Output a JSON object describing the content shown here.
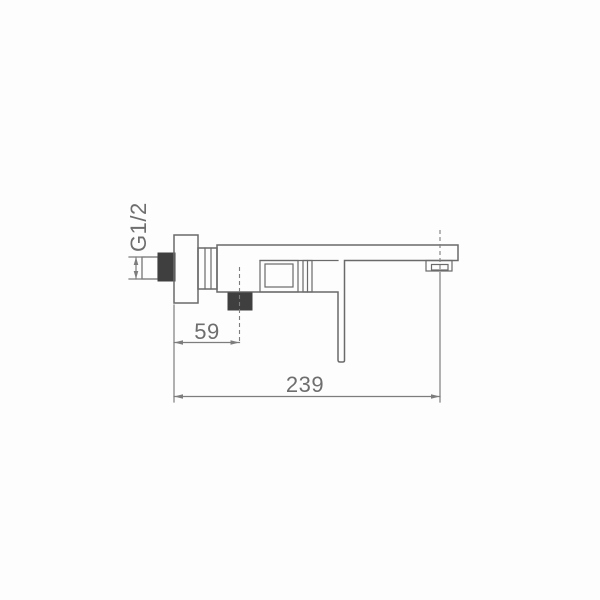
{
  "drawing": {
    "labels": {
      "thread": "G1/2",
      "dim_wall_to_shower_outlet": "59",
      "dim_wall_to_spout": "239"
    },
    "colors": {
      "paper": "#fdfdfd",
      "outline": "#6a6a6a",
      "dimension": "#7d7d7d",
      "text": "#6e6e6e",
      "dark_fill": "#3f3f3f"
    }
  }
}
